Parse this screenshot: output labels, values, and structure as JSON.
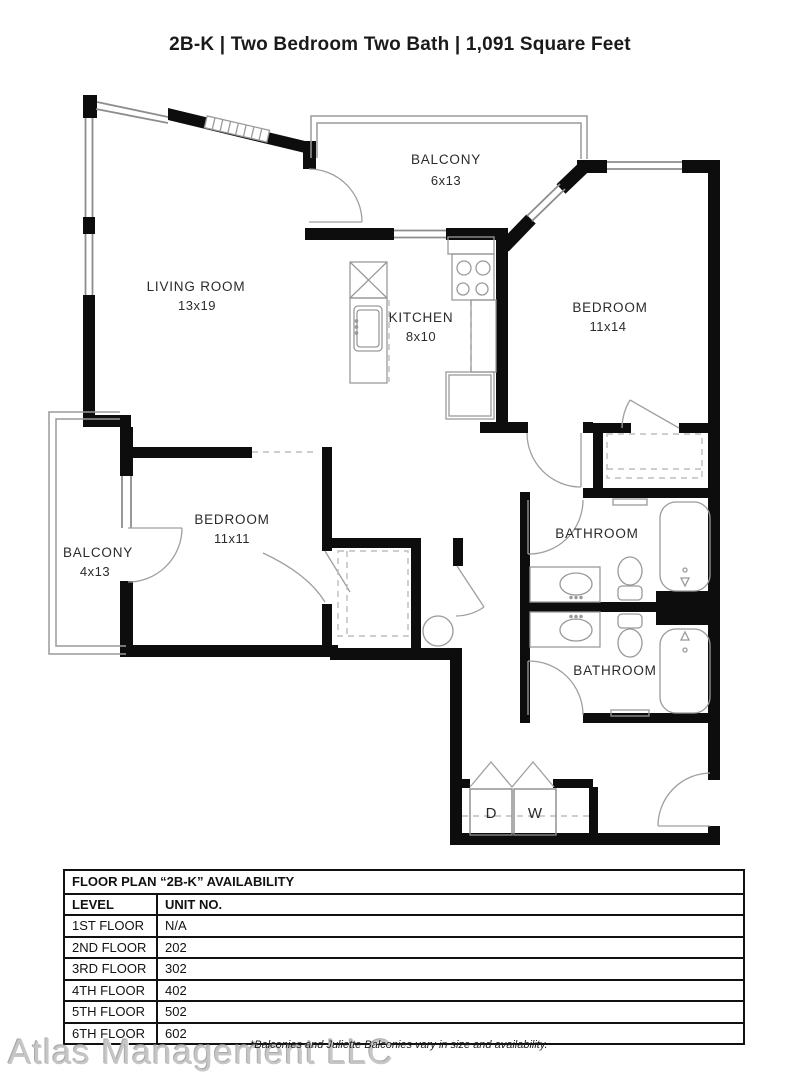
{
  "title": "2B-K | Two Bedroom Two Bath | 1,091 Square Feet",
  "rooms": {
    "balcony_top": {
      "label": "BALCONY",
      "dims": "6x13"
    },
    "living": {
      "label": "LIVING ROOM",
      "dims": "13x19"
    },
    "kitchen": {
      "label": "KITCHEN",
      "dims": "8x10"
    },
    "bedroom1": {
      "label": "BEDROOM",
      "dims": "11x14"
    },
    "bedroom2": {
      "label": "BEDROOM",
      "dims": "11x11"
    },
    "balcony_left": {
      "label": "BALCONY",
      "dims": "4x13"
    },
    "bath1": {
      "label": "BATHROOM"
    },
    "bath2": {
      "label": "BATHROOM"
    },
    "dryer": "D",
    "washer": "W"
  },
  "availability_table": {
    "title": "FLOOR PLAN “2B-K” AVAILABILITY",
    "columns": [
      "LEVEL",
      "UNIT NO."
    ],
    "rows": [
      {
        "level": "1ST FLOOR",
        "unit": "N/A"
      },
      {
        "level": "2ND FLOOR",
        "unit": "202"
      },
      {
        "level": "3RD FLOOR",
        "unit": "302"
      },
      {
        "level": "4TH FLOOR",
        "unit": "402"
      },
      {
        "level": "5TH FLOOR",
        "unit": "502"
      },
      {
        "level": "6TH FLOOR",
        "unit": "602"
      }
    ]
  },
  "watermark": "Atlas Management LLC",
  "footnote": "*Balconies and Juliette Balconies vary in size and availability.",
  "colors": {
    "wall": "#0d0d0d",
    "thin_line": "#909090",
    "dashed": "#bdbdbd"
  }
}
